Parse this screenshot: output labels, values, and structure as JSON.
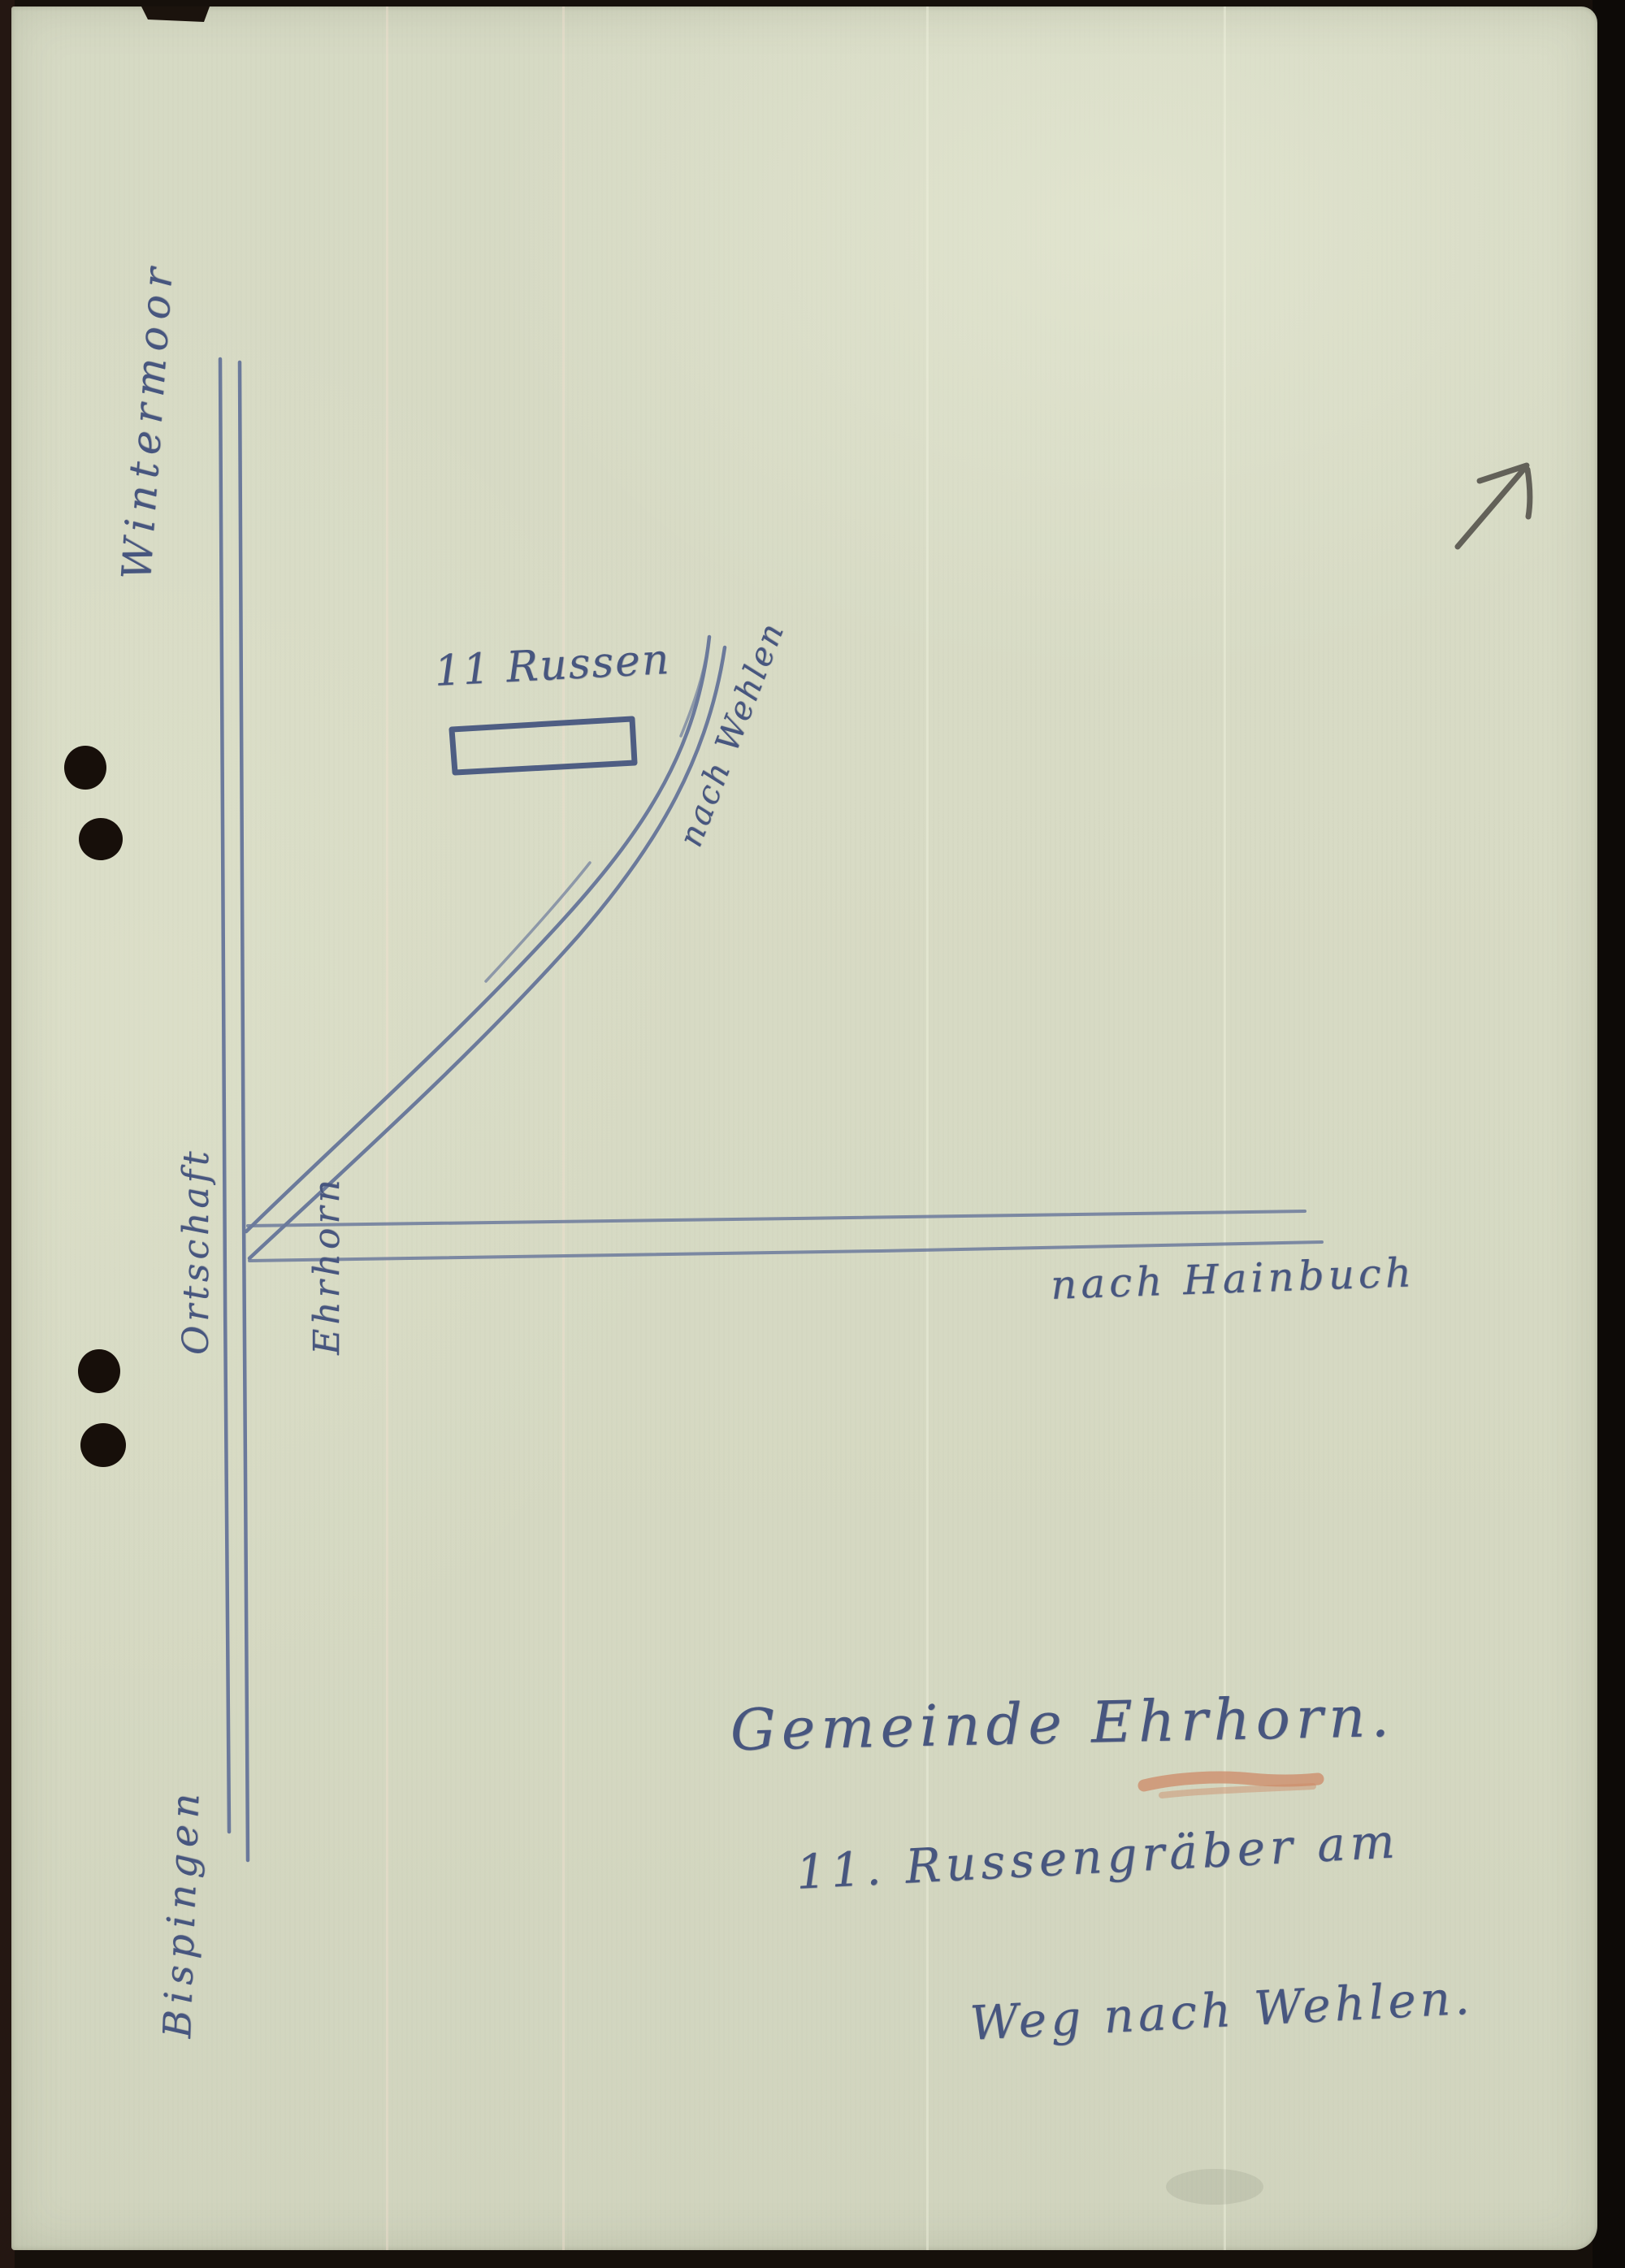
{
  "colors": {
    "paper": "#d7dac4",
    "surround": "#16100b",
    "ink_blue": "#47567f",
    "road_blue": "#5f6f97",
    "red_underline": "#cd8a67",
    "pencil_gray": "#53514a",
    "punch_hole": "#170f0a"
  },
  "map_labels": {
    "wintermoor": "Wintermoor",
    "ortschaft_line1": "Ortschaft",
    "ortschaft_line2": "Ehrhorn",
    "bispingen": "Bispingen",
    "nach_wehlen": "nach Wehlen",
    "nach_hainbuch": "nach Hainbuch",
    "grave_site": "11 Russen"
  },
  "caption": {
    "line1": "Gemeinde Ehrhorn.",
    "line2": "11. Russengräber am",
    "line3": "Weg nach Wehlen."
  }
}
